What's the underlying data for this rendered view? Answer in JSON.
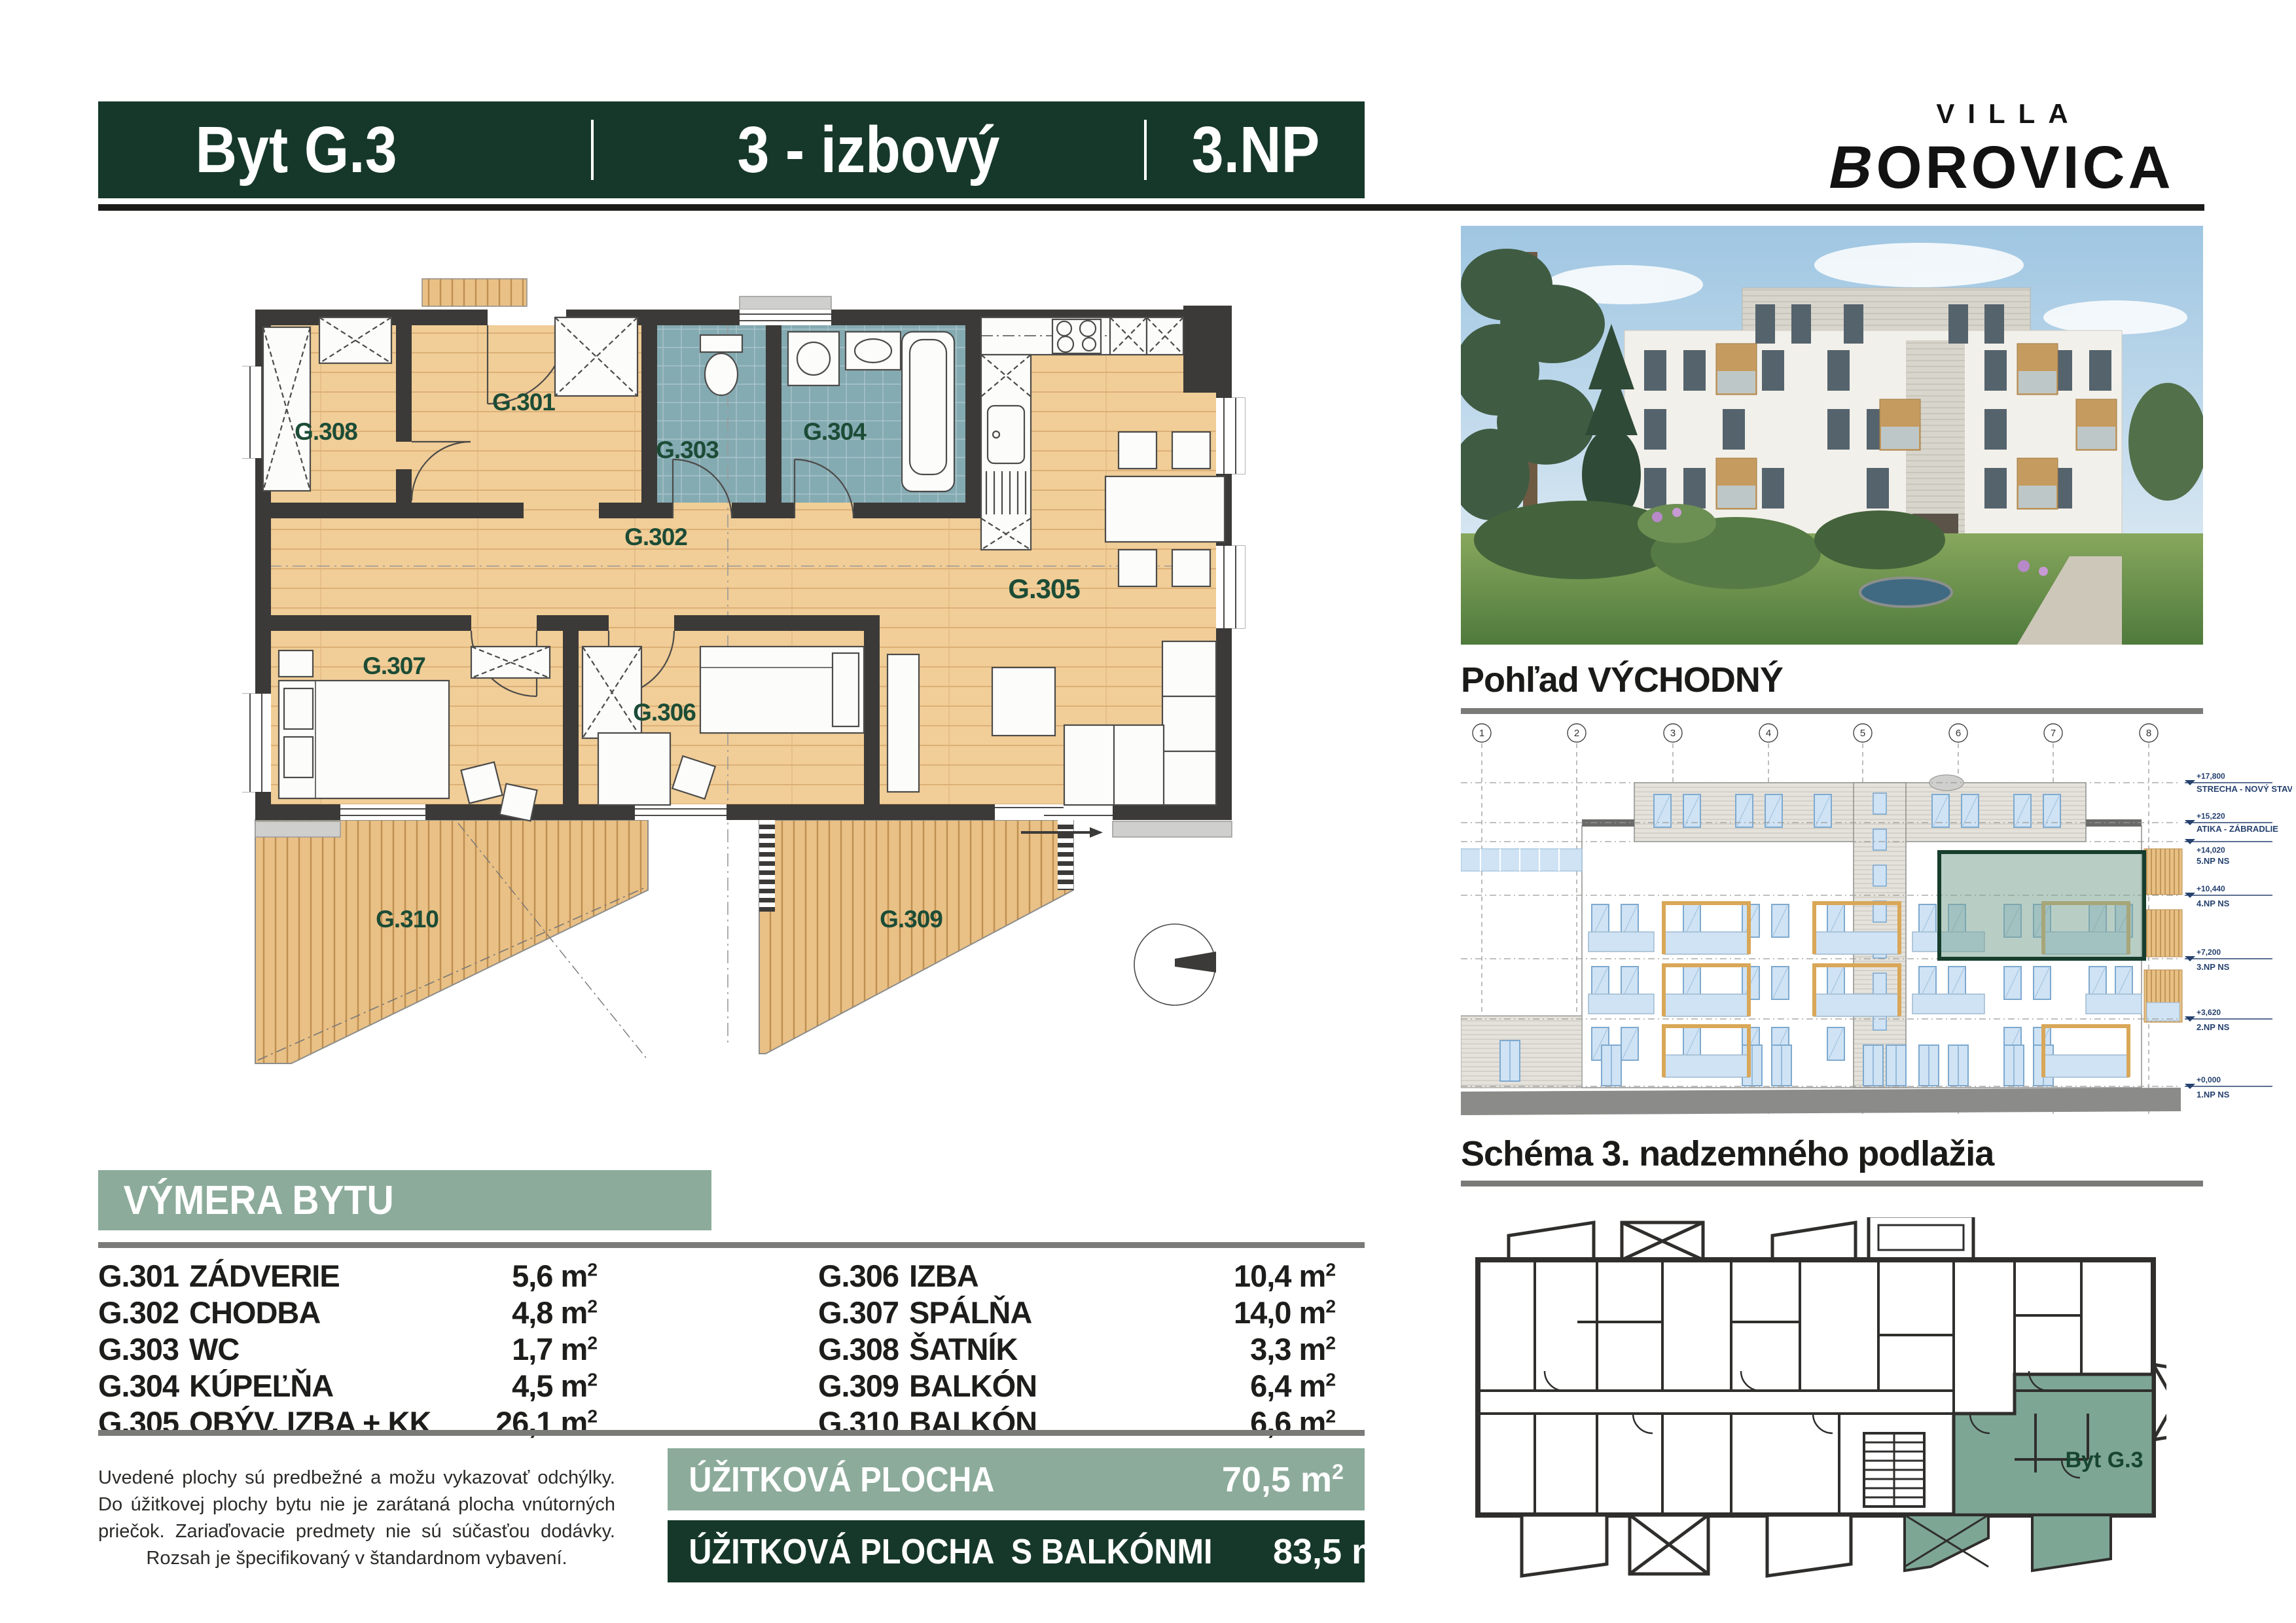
{
  "header": {
    "unit": "Byt G.3",
    "layout": "3 - izbový",
    "floor": "3.NP"
  },
  "brand": {
    "line1": "VILLA",
    "line2_first": "B",
    "line2_rest": "OROVICA"
  },
  "plan": {
    "room_labels": [
      "G.308",
      "G.301",
      "G.303",
      "G.304",
      "G.302",
      "G.305",
      "G.307",
      "G.306",
      "G.310",
      "G.309"
    ]
  },
  "area_table": {
    "title": "VÝMERA BYTU",
    "unit": "m",
    "sup": "2",
    "left_rows": [
      {
        "code": "G.301",
        "name": "ZÁDVERIE",
        "area": "5,6"
      },
      {
        "code": "G.302",
        "name": "CHODBA",
        "area": "4,8"
      },
      {
        "code": "G.303",
        "name": "WC",
        "area": "1,7"
      },
      {
        "code": "G.304",
        "name": "KÚPEĽŇA",
        "area": "4,5"
      },
      {
        "code": "G.305",
        "name": "OBÝV. IZBA + KK",
        "area": "26,1"
      }
    ],
    "right_rows": [
      {
        "code": "G.306",
        "name": "IZBA",
        "area": "10,4"
      },
      {
        "code": "G.307",
        "name": "SPÁLŇA",
        "area": "14,0"
      },
      {
        "code": "G.308",
        "name": "ŠATNÍK",
        "area": "3,3"
      },
      {
        "code": "G.309",
        "name": "BALKÓN",
        "area": "6,4"
      },
      {
        "code": "G.310",
        "name": "BALKÓN",
        "area": "6,6"
      }
    ]
  },
  "disclaimer": "Uvedené plochy sú predbežné a možu vykazovať odchýlky. Do úžitkovej plochy bytu nie je zarátaná plocha vnútorných priečok. Zariaďovacie predmety nie sú súčasťou dodávky. Rozsah je špecifikovaný v štandardnom vybavení.",
  "totals": {
    "usable": {
      "label": "ÚŽITKOVÁ PLOCHA",
      "area": "70,5"
    },
    "usable_with_balconies": {
      "label": "ÚŽITKOVÁ PLOCHA  S BALKÓNMI",
      "area": "83,5"
    }
  },
  "east_view": {
    "title": "Pohľad VÝCHODNÝ",
    "grid": [
      "1",
      "2",
      "3",
      "4",
      "5",
      "6",
      "7",
      "8"
    ],
    "levels": [
      {
        "elev": "+17,800",
        "name": "STRECHA - NOVÝ STAV"
      },
      {
        "elev": "+15,220",
        "name": "ATIKA - ZÁBRADLIE"
      },
      {
        "elev": "+14,020",
        "name": "5.NP NS"
      },
      {
        "elev": "+10,440",
        "name": "4.NP NS"
      },
      {
        "elev": "+7,200",
        "name": "3.NP NS"
      },
      {
        "elev": "+3,620",
        "name": "2.NP NS"
      },
      {
        "elev": "+0,000",
        "name": "1.NP NS"
      }
    ]
  },
  "schema": {
    "title": "Schéma 3. nadzemného podlažia",
    "highlight_label": "Byt G.3"
  },
  "colors": {
    "dark_green": "#16382b",
    "sage": "#8cab9b",
    "label_green": "#1c4c36",
    "wall": "#3b3a38",
    "wood_floor": "#f1cd97",
    "tile": "#84aab2",
    "highlight": "#7da695",
    "window_blue": "#cfe3f5",
    "balcony_wood": "#d9a758"
  }
}
